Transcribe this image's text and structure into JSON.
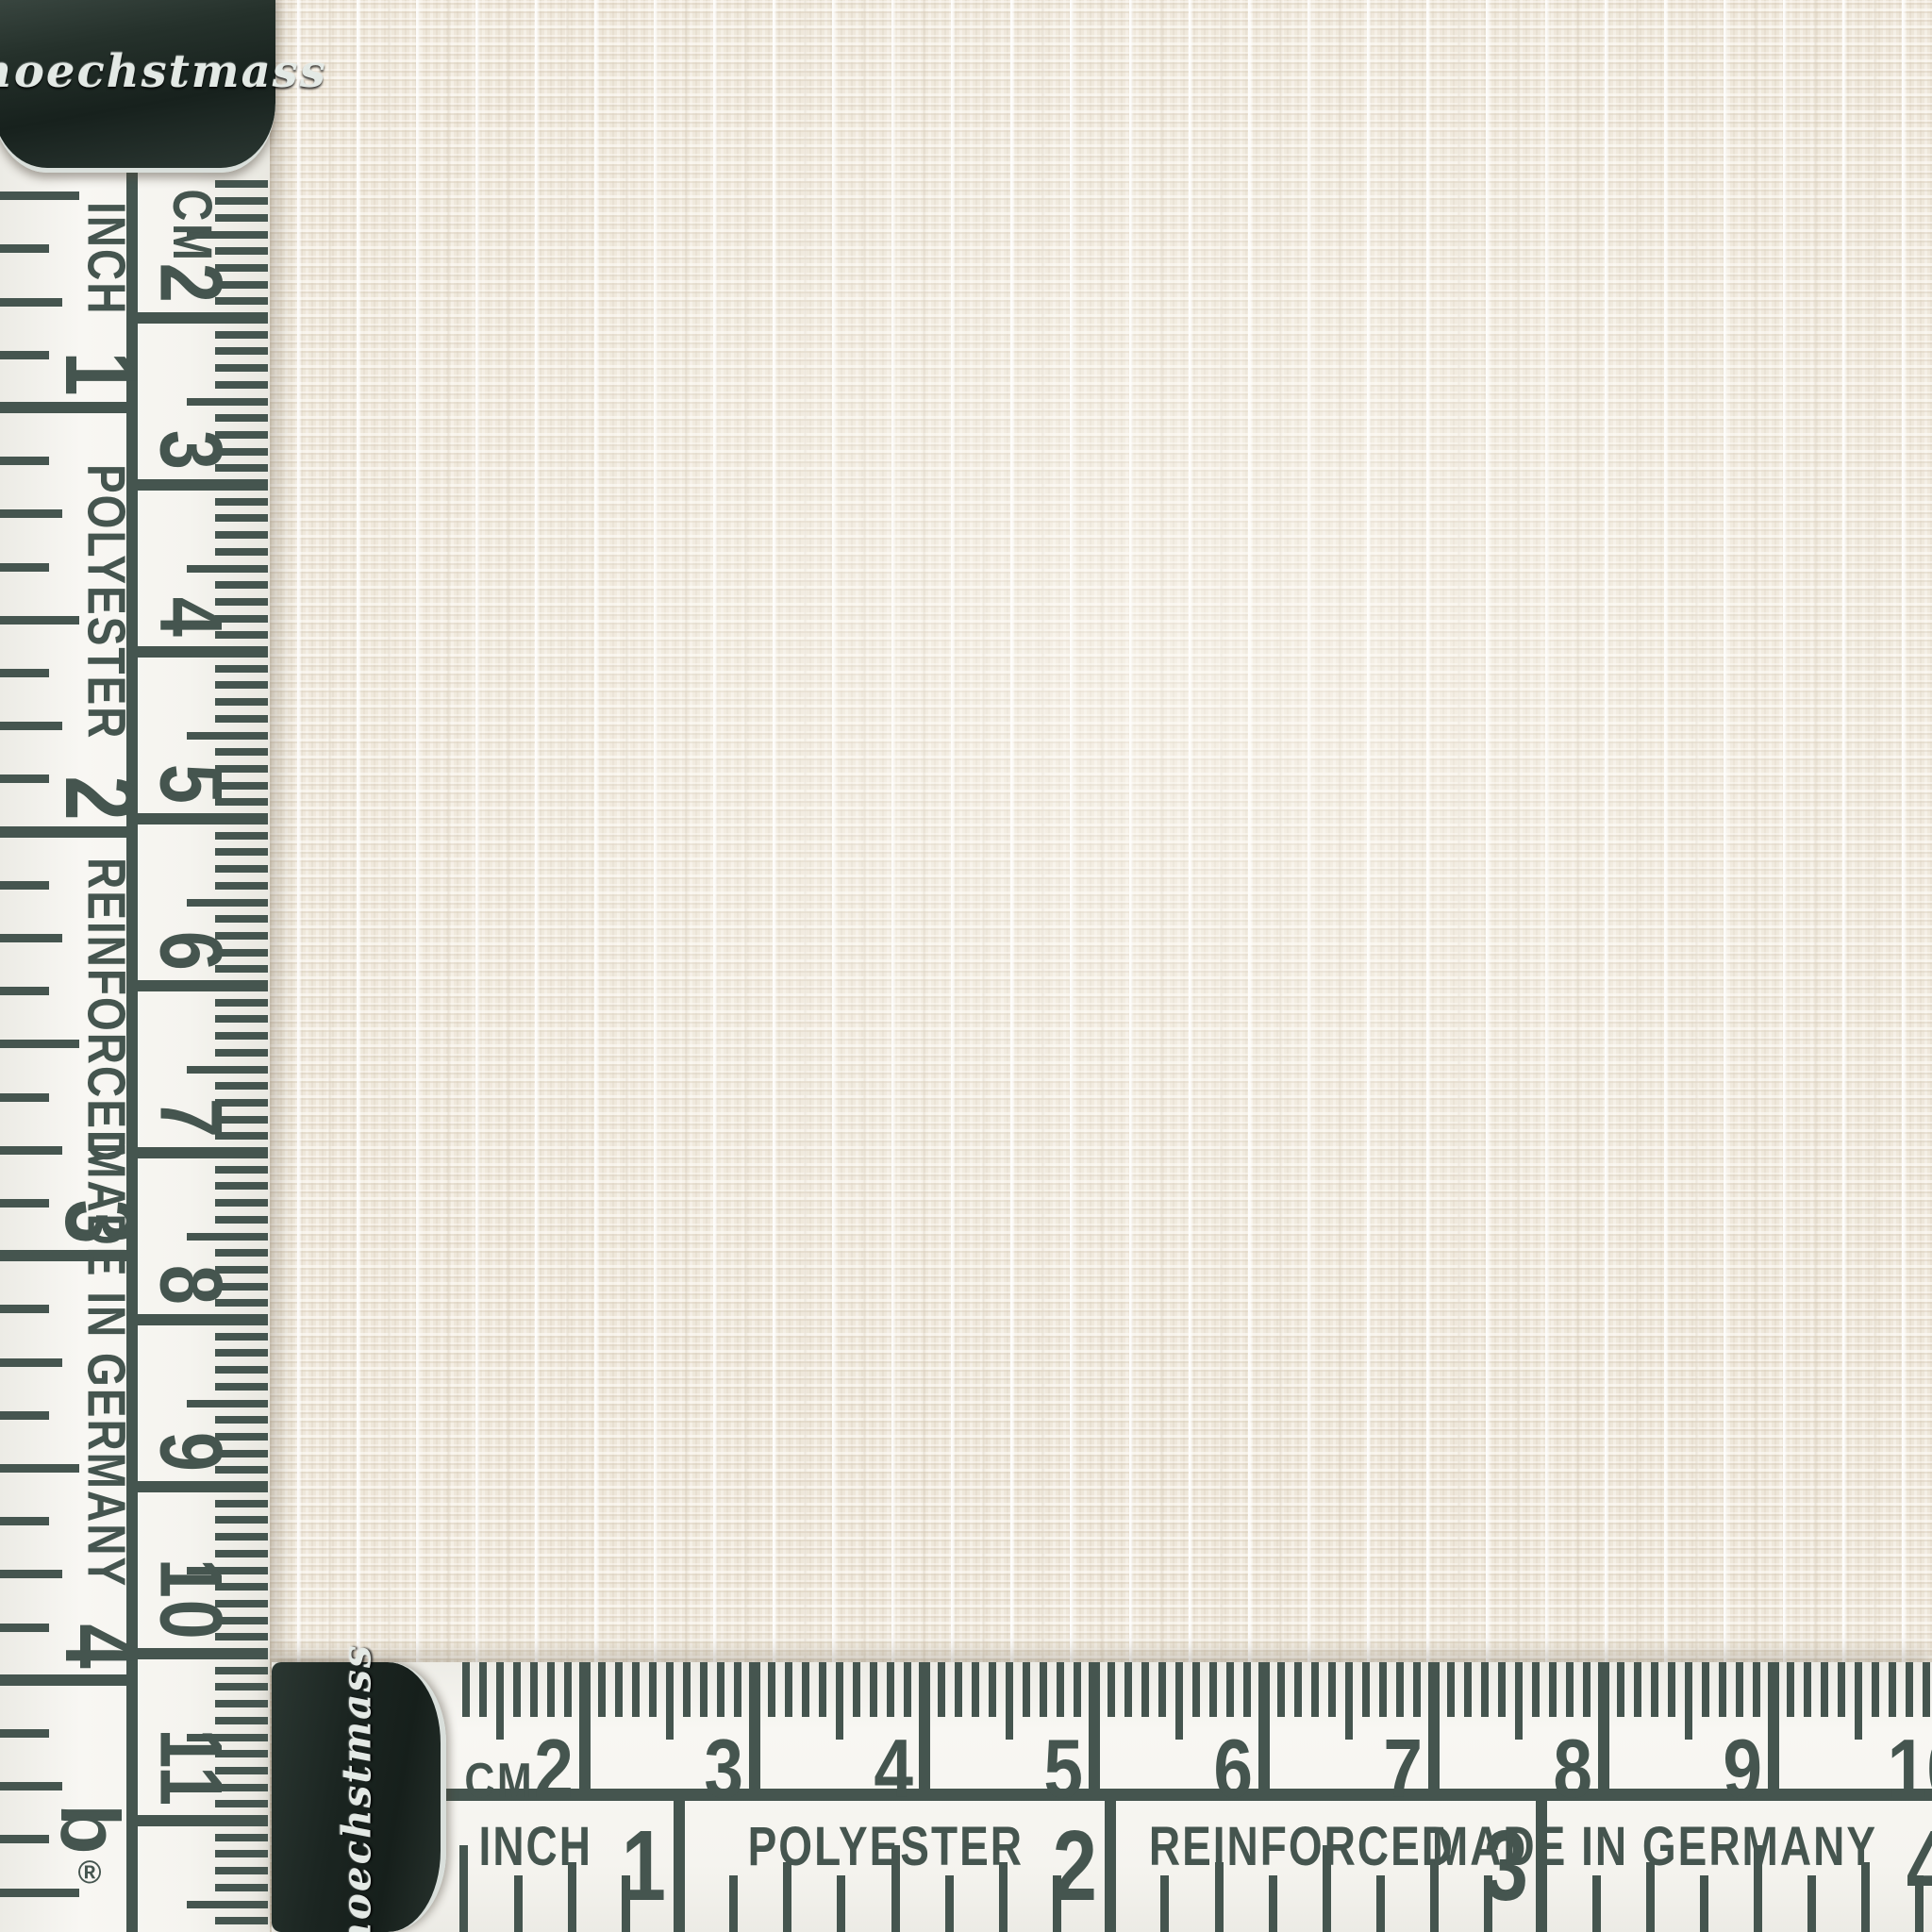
{
  "brand": {
    "name": "hoechstmass",
    "logo_letter": "b",
    "registered_mark": "®"
  },
  "colors": {
    "ink": "#45554f",
    "tape_white": "#f6f5f0",
    "metal_dark": "#1e2924",
    "metal_silver": "#d9dfdb",
    "fabric_base": "#efe8db"
  },
  "vertical_tape": {
    "unit_cm_label": "CM",
    "cm_numbers": [
      "2",
      "3",
      "4",
      "5",
      "6",
      "7",
      "8",
      "9",
      "10",
      "11"
    ],
    "inch_numbers": [
      "1",
      "2",
      "3",
      "4"
    ],
    "inch_texts": [
      "INCH",
      "POLYESTER",
      "REINFORCED",
      "MADE IN GERMANY"
    ]
  },
  "horizontal_tape": {
    "unit_cm_label": "CM",
    "cm_numbers": [
      "2",
      "3",
      "4",
      "5",
      "6",
      "7",
      "8",
      "9",
      "10"
    ],
    "inch_numbers": [
      "1",
      "2",
      "3",
      "4"
    ],
    "inch_texts": [
      "INCH",
      "POLYESTER",
      "REINFORCED",
      "MADE IN GERMANY"
    ]
  }
}
